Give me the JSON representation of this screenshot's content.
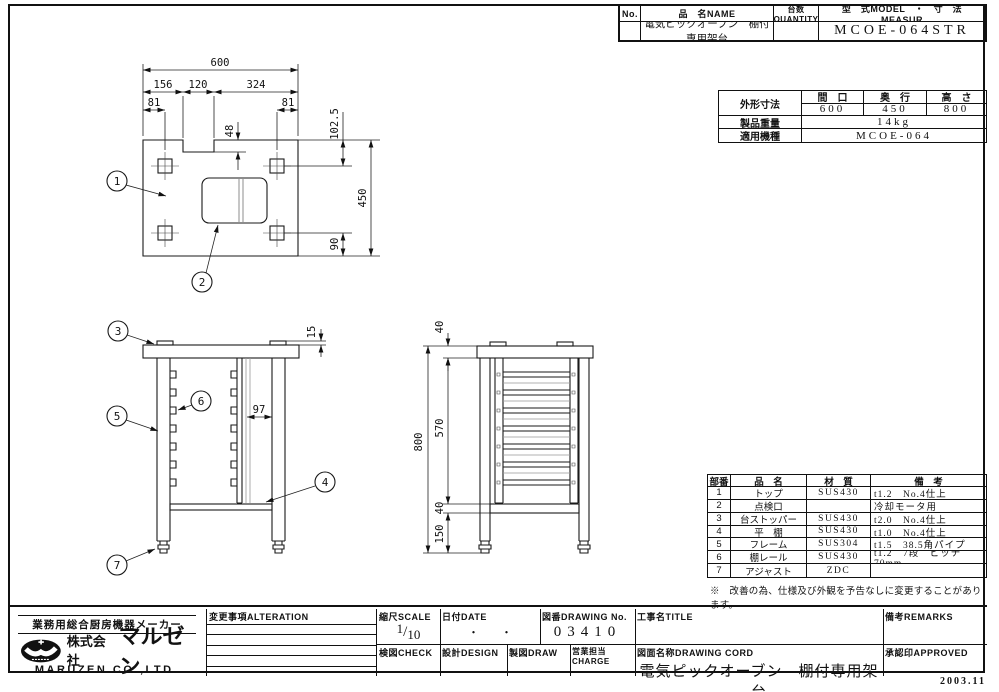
{
  "sheet": {
    "issue_date": "2003.11"
  },
  "header_table": {
    "no_label": "No.",
    "name_label": "品　名NAME",
    "qty_label": "台数QUANTITY",
    "model_label": "型　式MODEL　・　寸　法MEASUR",
    "name_value": "電気ピックオーブン　棚付専用架台",
    "model_value": "MCOE-064STR"
  },
  "spec_table": {
    "dims_label": "外形寸法",
    "width_label": "間　口",
    "depth_label": "奥　行",
    "height_label": "高　さ",
    "width_value": "600",
    "depth_value": "450",
    "height_value": "800",
    "weight_label": "製品重量",
    "weight_value": "14kg",
    "model_label": "適用機種",
    "model_value": "MCOE-064"
  },
  "parts_table": {
    "col_no": "部番",
    "col_name": "品　名",
    "col_material": "材　質",
    "col_remarks": "備　考",
    "rows": [
      {
        "no": "1",
        "name": "トップ",
        "material": "SUS430",
        "remarks": "t1.2　No.4仕上"
      },
      {
        "no": "2",
        "name": "点検口",
        "material": "",
        "remarks": "冷却モータ用"
      },
      {
        "no": "3",
        "name": "台ストッパー",
        "material": "SUS430",
        "remarks": "t2.0　No.4仕上"
      },
      {
        "no": "4",
        "name": "平　棚",
        "material": "SUS430",
        "remarks": "t1.0　No.4仕上"
      },
      {
        "no": "5",
        "name": "フレーム",
        "material": "SUS304",
        "remarks": "t1.5　38.5角パイプ"
      },
      {
        "no": "6",
        "name": "棚レール",
        "material": "SUS430",
        "remarks": "t1.2　7段　ピッチ70mm"
      },
      {
        "no": "7",
        "name": "アジャスト",
        "material": "ZDC",
        "remarks": ""
      }
    ],
    "note": "※　改善の為、仕様及び外観を予告なしに変更することがあります。"
  },
  "title_block": {
    "maker_tagline": "業務用総合厨房機器メーカー",
    "company_prefix": "株式会社",
    "company_logo_text": "マルゼン",
    "company_en": "MARUZEN CO.,LTD.",
    "alteration_label": "変更事項ALTERATION",
    "scale_label": "縮尺SCALE",
    "scale_num": "1",
    "scale_den": "10",
    "date_label": "日付DATE",
    "date_value": "・　　・",
    "drawing_no_label": "図番DRAWING No.",
    "drawing_no_value": "03410",
    "title_label": "工事名TITLE",
    "remarks_label": "備考REMARKS",
    "check_label": "検図CHECK",
    "design_label": "設計DESIGN",
    "draw_label": "製図DRAW",
    "charge_label": "営業担当CHARGE",
    "drawing_name_label": "図面名称DRAWING CORD",
    "drawing_name_value": "電気ピックオーブン　棚付専用架台",
    "approved_label": "承認印APPROVED"
  },
  "drawing": {
    "balloons": {
      "b1": "1",
      "b2": "2",
      "b3": "3",
      "b4": "4",
      "b5": "5",
      "b6": "6",
      "b7": "7"
    },
    "top_view": {
      "overall_width": "600",
      "seg_left": "156",
      "seg_notch": "120",
      "seg_right": "324",
      "leg_offset_left": "81",
      "leg_offset_right": "81",
      "notch_depth": "48",
      "top_to_leg": "102.5",
      "overall_depth": "450",
      "leg_to_edge": "90"
    },
    "front_view": {
      "stopper_height": "15",
      "rail_gap": "97"
    },
    "side_view": {
      "top_height": "40",
      "overall_height": "800",
      "rail_height": "570",
      "shelf_height": "40",
      "leg_bottom": "150"
    }
  }
}
